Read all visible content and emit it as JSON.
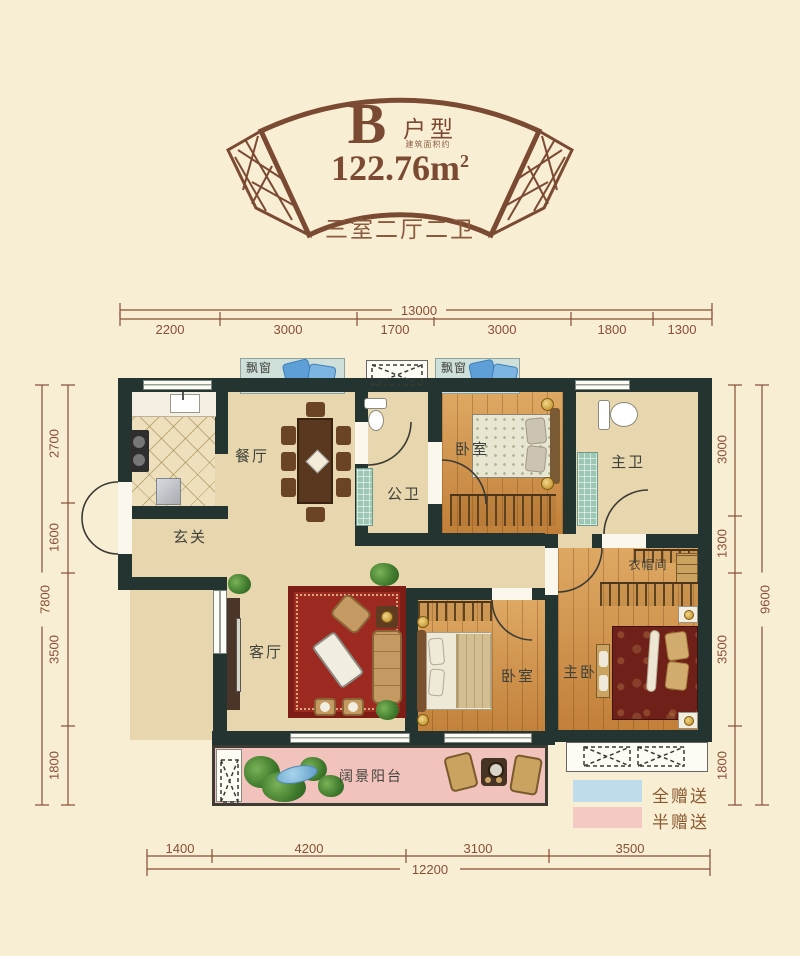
{
  "header": {
    "type_letter": "B",
    "type_label": "户型",
    "area_prefix": "建筑面积约",
    "area_value": "122.76m",
    "area_sup": "2",
    "subtitle": "三室二厅二卫"
  },
  "dimensions": {
    "top": {
      "total": "13000",
      "segments": [
        "2200",
        "3000",
        "1700",
        "3000",
        "1800",
        "1300"
      ]
    },
    "bottom": {
      "total": "12200",
      "segments": [
        "1400",
        "4200",
        "3100",
        "3500"
      ]
    },
    "left": {
      "total": "7800",
      "segments": [
        "2700",
        "1600",
        "3500",
        "1800"
      ]
    },
    "right": {
      "total": "9600",
      "segments": [
        "3000",
        "1300",
        "3500",
        "1800"
      ]
    }
  },
  "rooms": {
    "bay_window_1": "飘窗",
    "bay_window_2": "飘窗",
    "dining": "餐厅",
    "entry": "玄关",
    "public_bath": "公卫",
    "bedroom_top": "卧室",
    "master_bath": "主卫",
    "cloakroom": "衣帽间",
    "master_bedroom": "主卧",
    "living": "客厅",
    "bedroom_bottom": "卧室",
    "balcony": "阔景阳台"
  },
  "legend": {
    "full_gift": {
      "label": "全赠送",
      "color": "#bfdcec"
    },
    "half_gift": {
      "label": "半赠送",
      "color": "#f4c9c4"
    }
  },
  "colors": {
    "background": "#f8eed4",
    "wall": "#243531",
    "accent_brown": "#7b4a32",
    "dimension_text": "#874f35",
    "balcony_pink": "#f2c3bd",
    "bay_blue": "#cfe0da",
    "wood": "#d09045",
    "carpet_red": "#9c2a21"
  }
}
